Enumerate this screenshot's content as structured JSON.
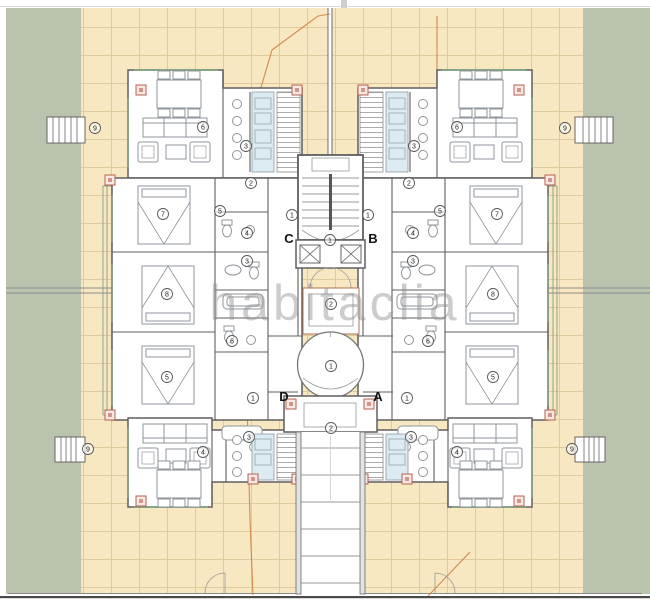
{
  "watermark": "habitaclia",
  "units": {
    "A": "A",
    "B": "B",
    "C": "C",
    "D": "D"
  },
  "room_labels": {
    "mirrored": [
      {
        "n": "9",
        "x": 95,
        "y": 128
      },
      {
        "n": "6",
        "x": 203,
        "y": 127
      },
      {
        "n": "3",
        "x": 246,
        "y": 146
      },
      {
        "n": "2",
        "x": 251,
        "y": 183
      },
      {
        "n": "7",
        "x": 163,
        "y": 214
      },
      {
        "n": "5",
        "x": 220,
        "y": 211
      },
      {
        "n": "4",
        "x": 247,
        "y": 233
      },
      {
        "n": "3",
        "x": 247,
        "y": 261
      },
      {
        "n": "8",
        "x": 167,
        "y": 294
      },
      {
        "n": "6",
        "x": 232,
        "y": 341
      },
      {
        "n": "5",
        "x": 167,
        "y": 377
      },
      {
        "n": "1",
        "x": 292,
        "y": 215
      },
      {
        "n": "1",
        "x": 253,
        "y": 398
      },
      {
        "n": "4",
        "x": 203,
        "y": 452
      },
      {
        "n": "3",
        "x": 249,
        "y": 437
      },
      {
        "n": "9",
        "x": 88,
        "y": 449
      }
    ],
    "center": [
      {
        "n": "1",
        "x": 330,
        "y": 240
      },
      {
        "n": "2",
        "x": 331,
        "y": 304
      },
      {
        "n": "1",
        "x": 331,
        "y": 366
      },
      {
        "n": "2",
        "x": 331,
        "y": 428
      }
    ],
    "mirror_axis": 660
  },
  "colors": {
    "lawn": "#b9c3ae",
    "terrace": "#f8e8c2",
    "tile_line": "#c9b17f",
    "wall": "#5f5f5f",
    "furniture": "#8f959c",
    "accent": "#b85f52",
    "boundary": "#c97a3e",
    "kitchen": "#dcebf2",
    "rail": "#8fa58b",
    "window": "#7da37d",
    "watermark": "#8f8f8f",
    "dark_edge": "#4a4a4a"
  }
}
